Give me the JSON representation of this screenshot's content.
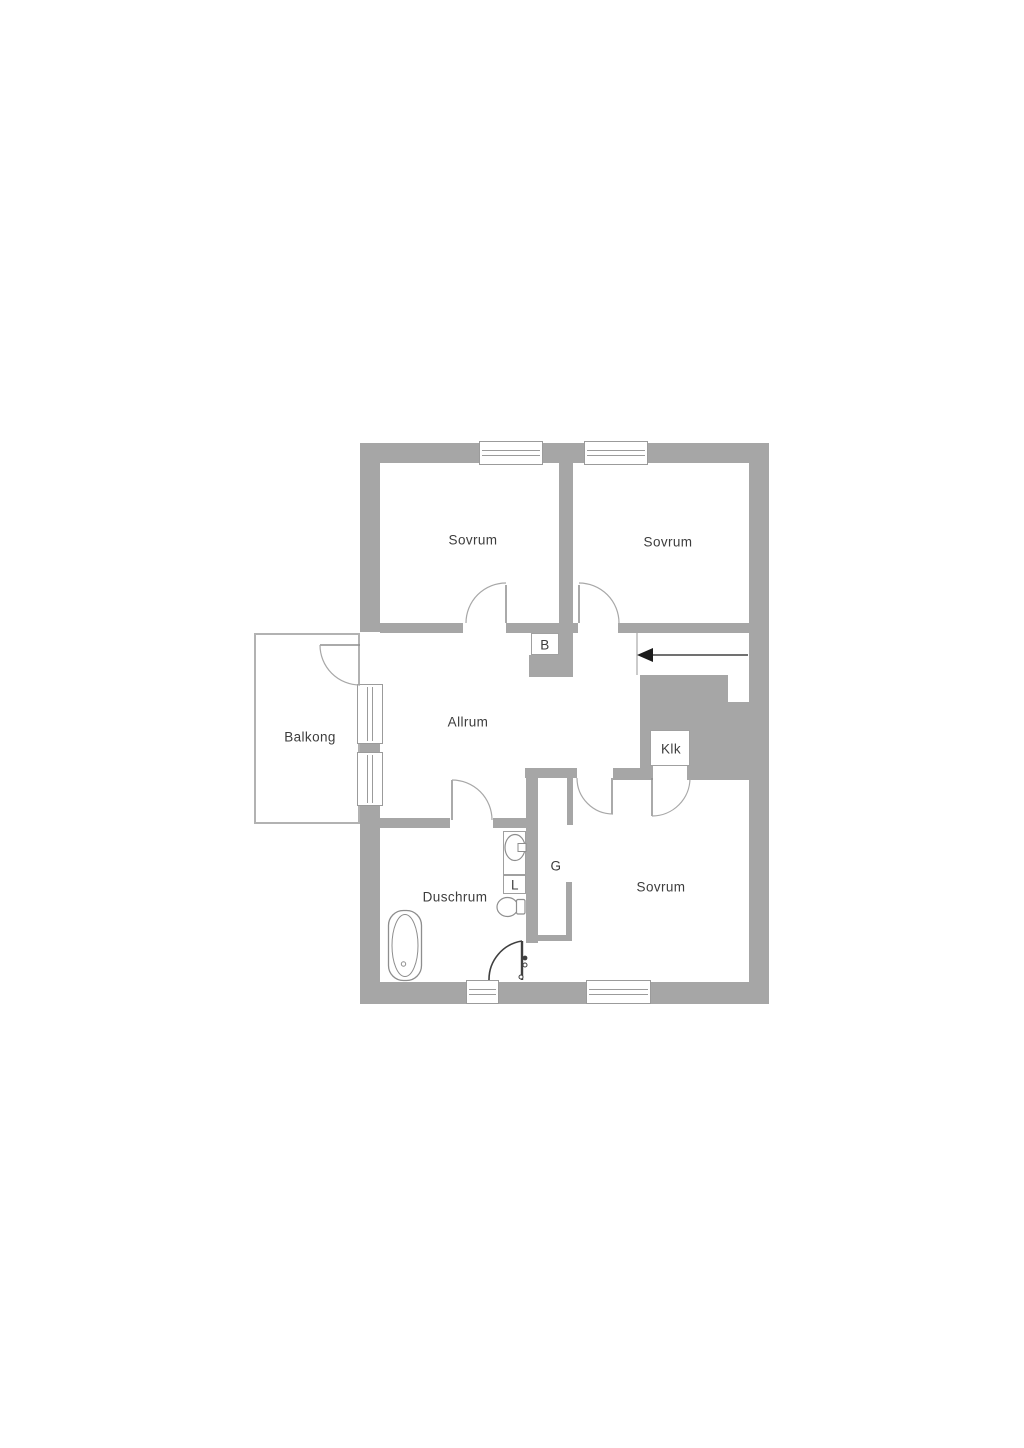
{
  "fp": {
    "rooms": {
      "bedroom_top_left": "Sovrum",
      "bedroom_top_right": "Sovrum",
      "bedroom_bottom": "Sovrum",
      "living_room": "Allrum",
      "balcony": "Balkong",
      "shower_room": "Duschrum",
      "walk_in_closet": "Klk",
      "wardrobe": "G",
      "linen_closet": "L",
      "niche": "B"
    },
    "stairs": {
      "arrow_direction": "left"
    },
    "fixtures": [
      "bathtub",
      "sink",
      "toilet"
    ],
    "colors": {
      "wall": "#a6a6a6",
      "outline": "#8e8e8e",
      "text": "#3d3d3d",
      "dark_door": "#3f3f3f",
      "background": "#ffffff"
    }
  }
}
